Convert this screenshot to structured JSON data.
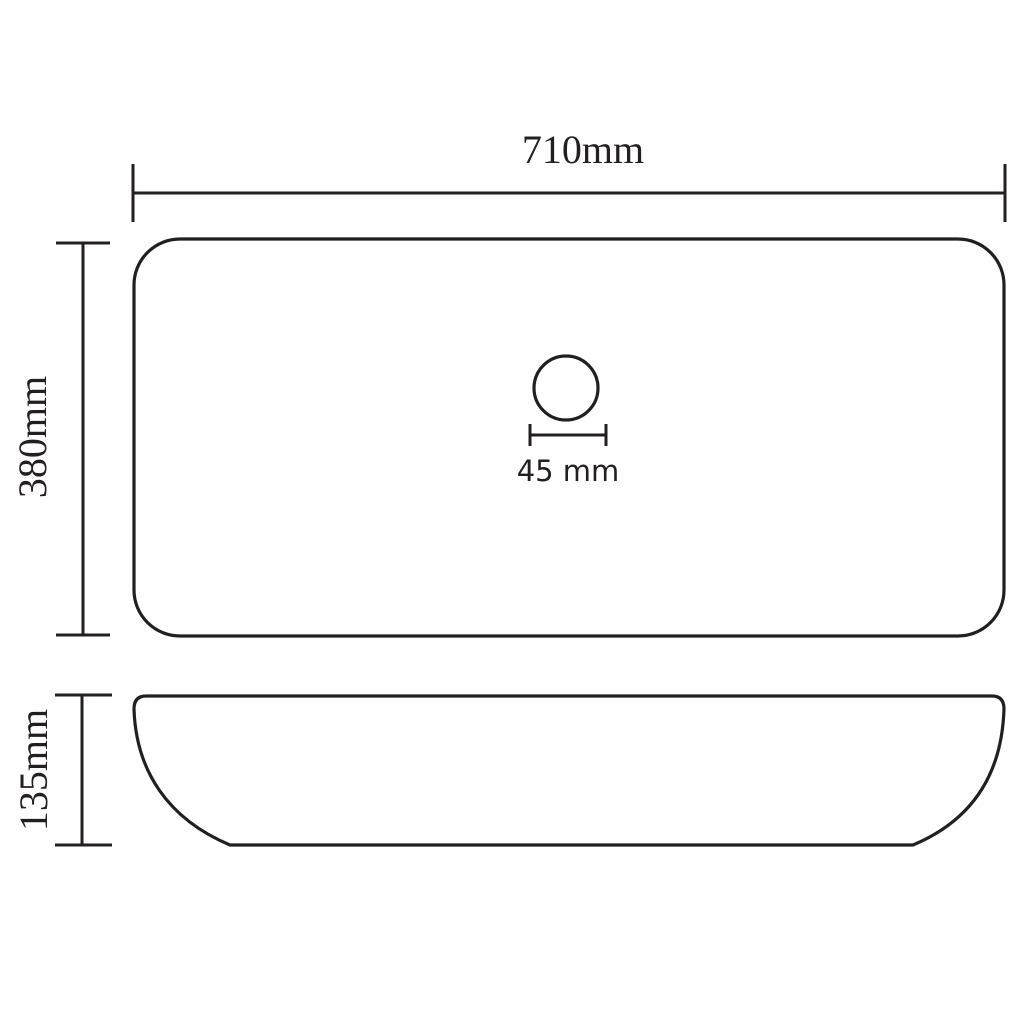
{
  "drawing": {
    "background": "#ffffff",
    "line_color": "#231f20",
    "subject": "rectangular-basin-dimension-drawing",
    "dimensions": {
      "width_label": "710mm",
      "depth_label": "380mm",
      "height_label": "135mm",
      "drain_label": "45 mm"
    }
  }
}
